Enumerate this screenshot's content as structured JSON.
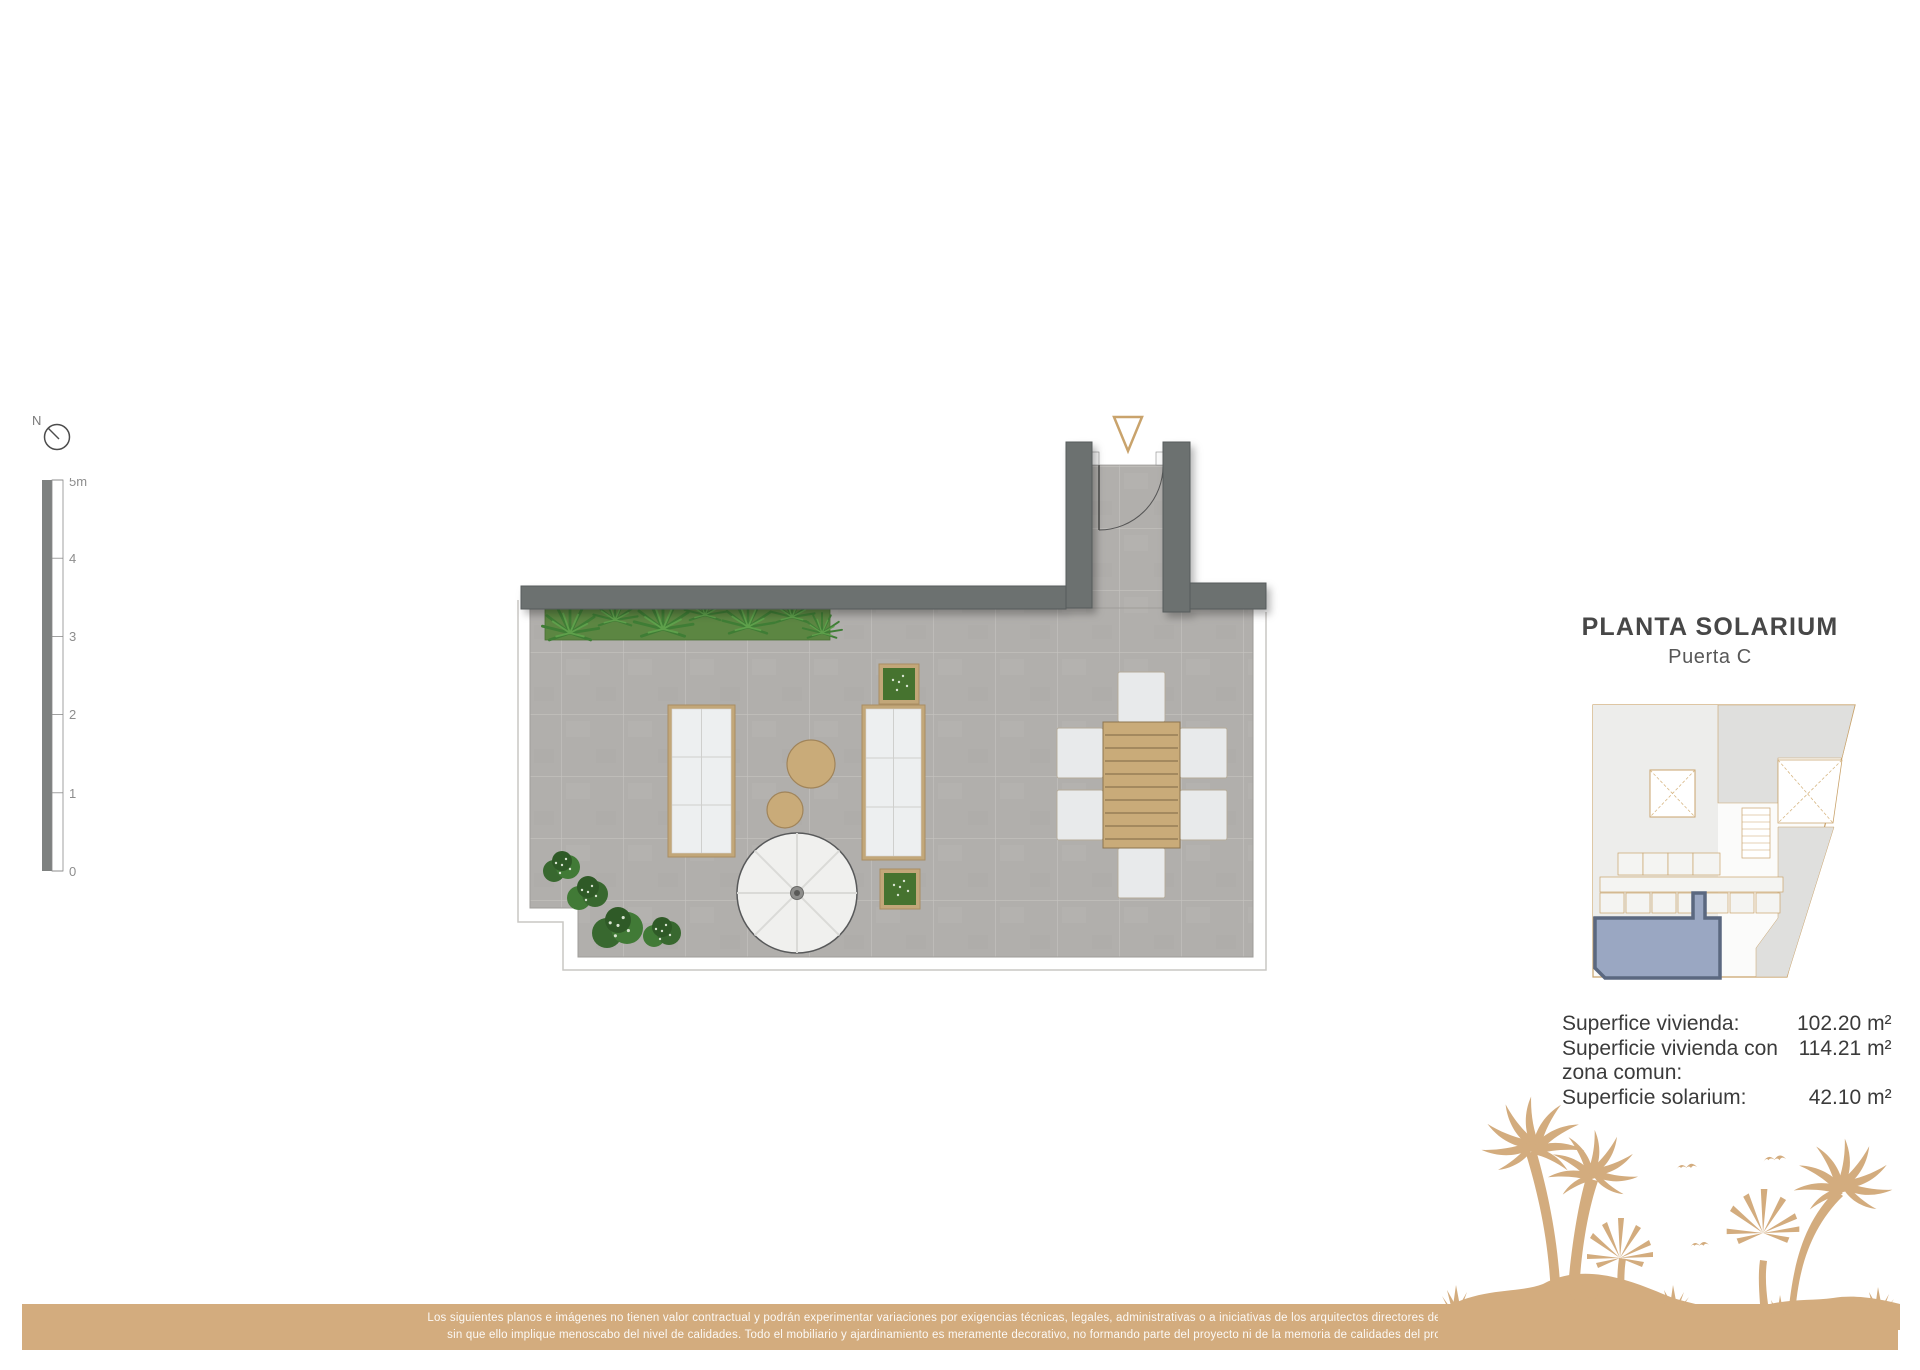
{
  "header": {
    "title": "PLANTA SOLARIUM",
    "subtitle": "Puerta C"
  },
  "compass": {
    "north_label": "N"
  },
  "scale_bar": {
    "ticks": [
      "5m",
      "4",
      "3",
      "2",
      "1",
      "0"
    ]
  },
  "areas": {
    "rows": [
      {
        "label": "Superfice vivienda:",
        "value": "102.20 m²"
      },
      {
        "label": "Superficie vivienda con zona comun:",
        "value": "114.21 m²"
      },
      {
        "label": "Superficie solarium:",
        "value": "42.10 m²"
      }
    ]
  },
  "footer": {
    "disclaimer_line1": "Los siguientes planos e imágenes no tienen valor contractual y podrán experimentar variaciones por exigencias técnicas, legales, administrativas o a iniciativas de los arquitectos directores de las obras",
    "disclaimer_line2": "sin que ello implique menoscabo del nivel de calidades. Todo el mobiliario y ajardinamiento es meramente decorativo, no formando parte del proyecto ni de la memoria de calidades del proyecto."
  },
  "colors": {
    "accent_tan": "#d3ac7e",
    "wall_gray": "#6c7170",
    "floor_tile": "#b1afac",
    "plant_green": "#4f8a3f",
    "bush_green": "#3c6b32",
    "unit_fill": "#9aa7c2",
    "unit_stroke": "#5b6880",
    "keyplan_line": "#c9a36c",
    "text_dark": "#474747"
  }
}
